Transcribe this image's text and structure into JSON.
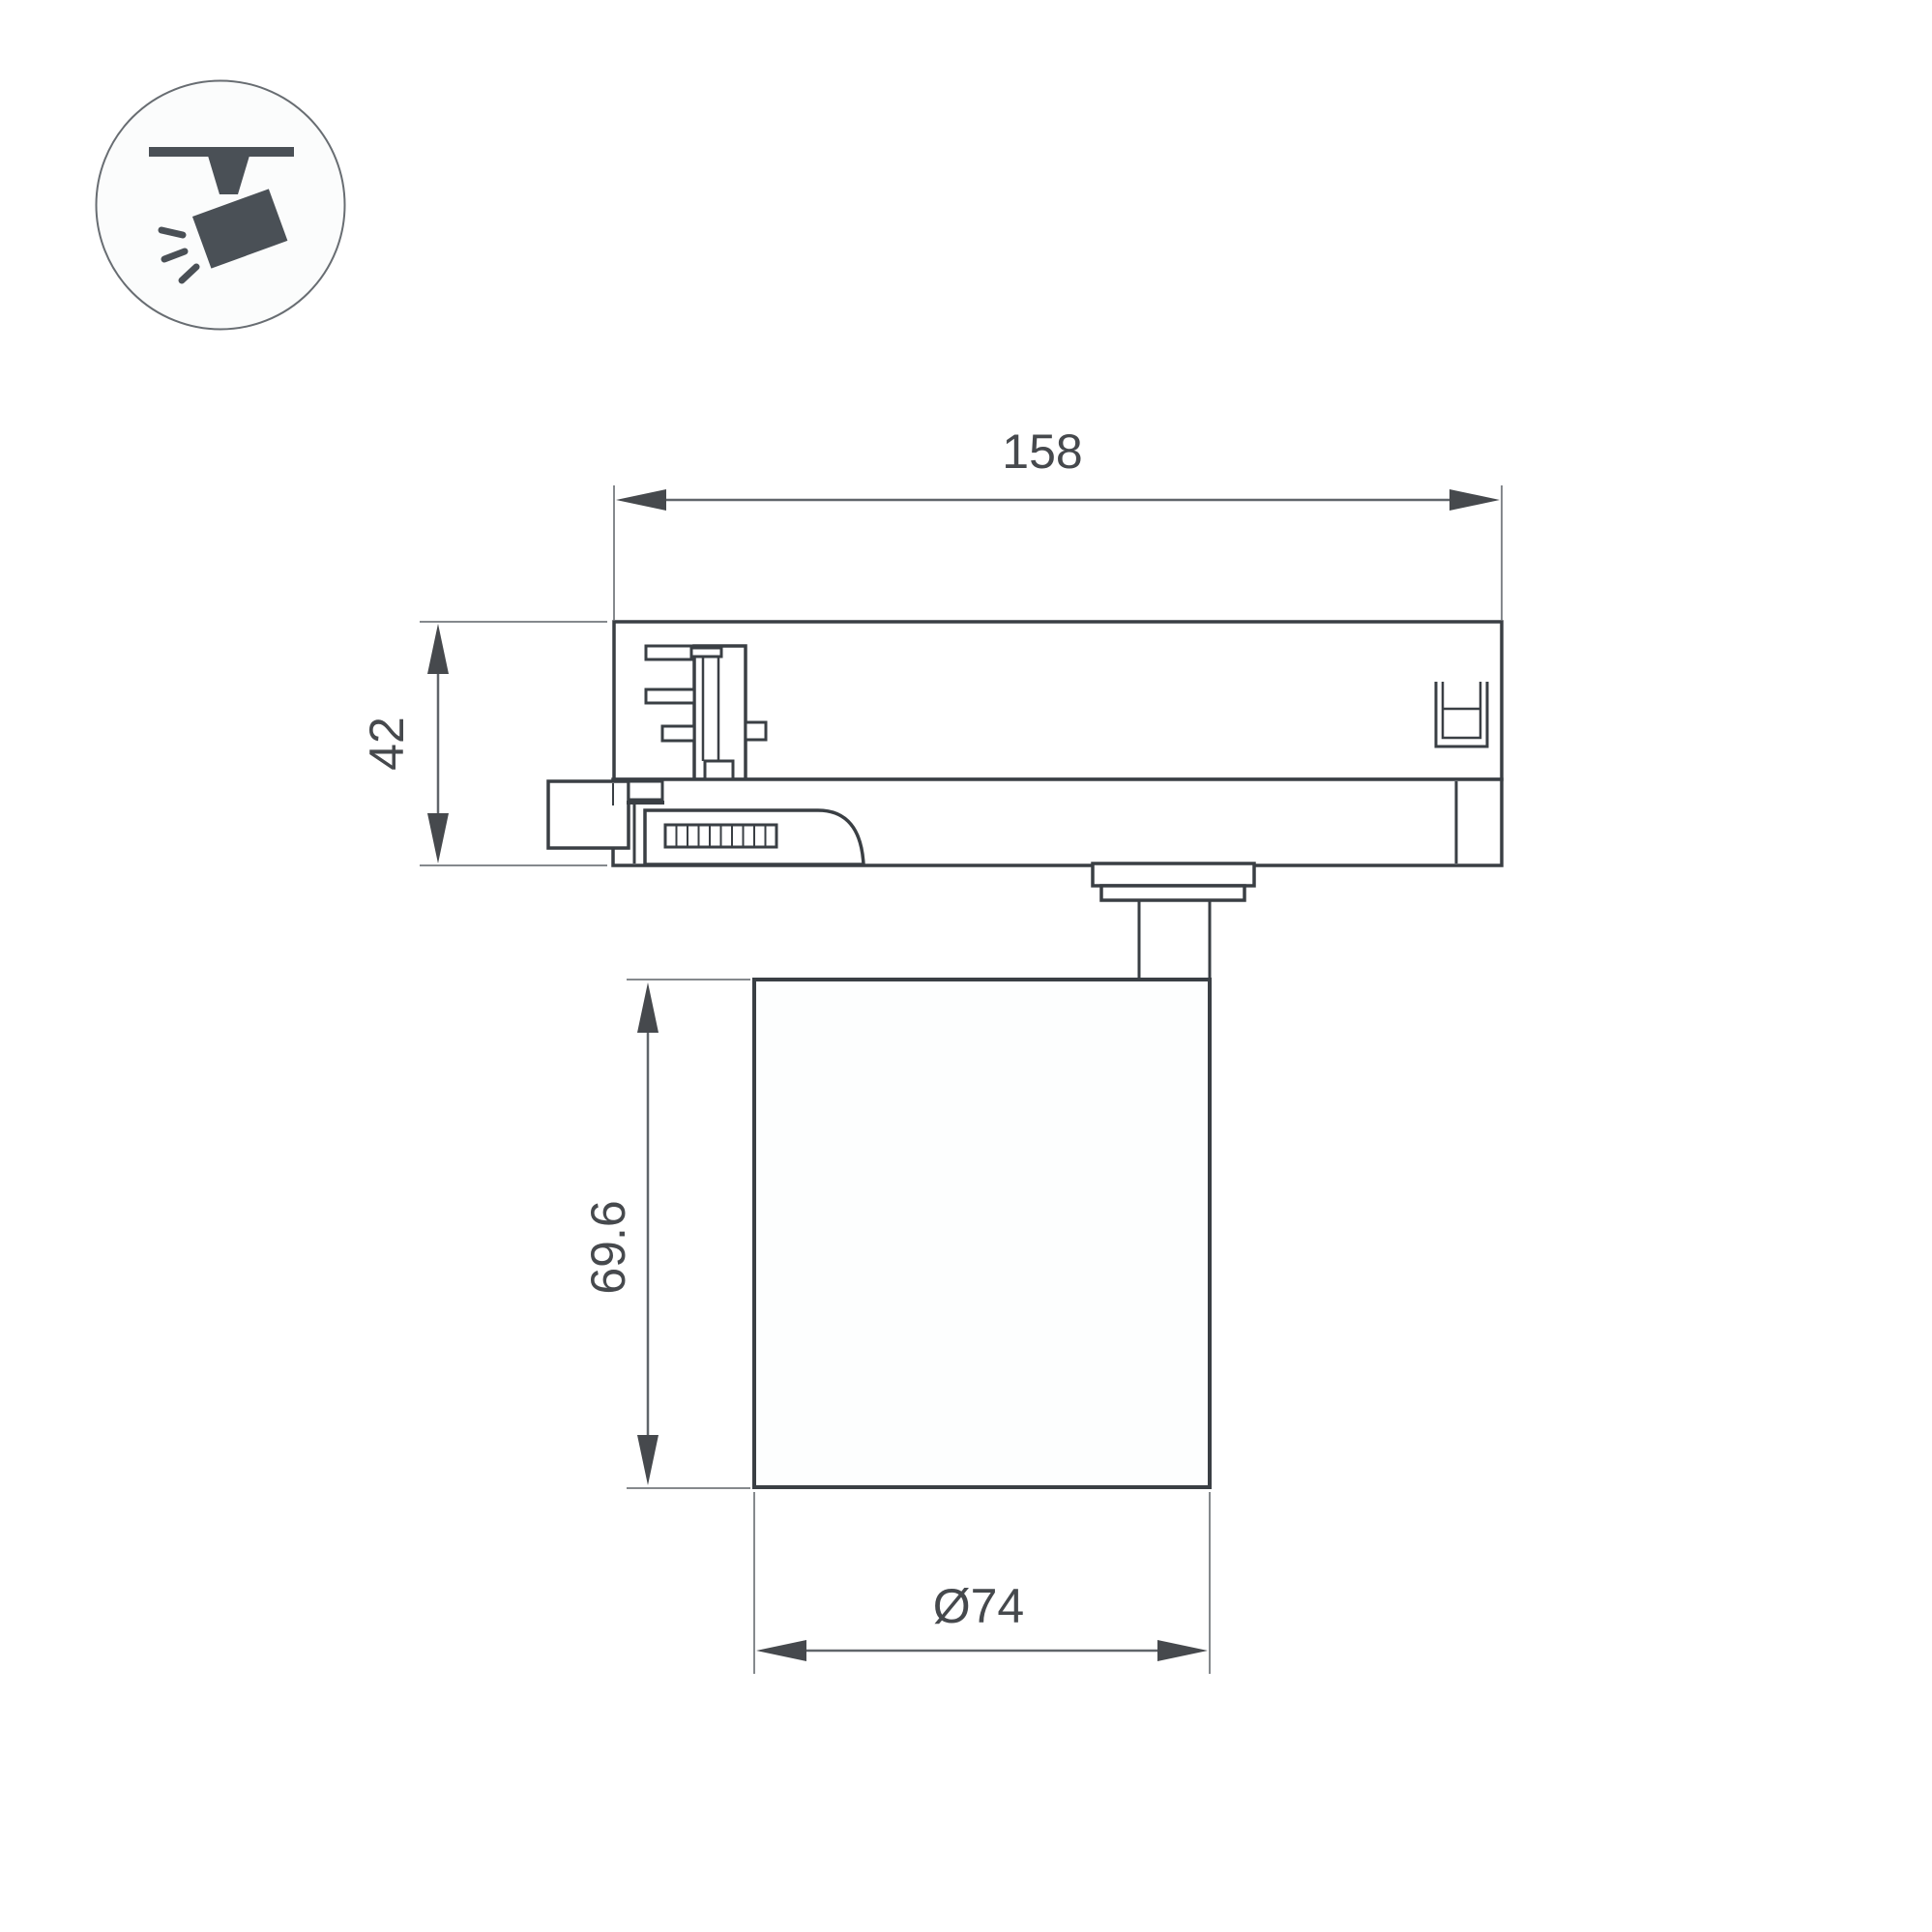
{
  "drawing": {
    "type": "technical-dimension-drawing",
    "subject": "track-light-fixture-side-view",
    "labels": {
      "adapter_width": "158",
      "adapter_height": "42",
      "body_height": "69.6",
      "body_diameter": "Ø74"
    },
    "icon": {
      "name": "track-spotlight-icon",
      "fill": "#4a5056",
      "circle_stroke": "#686d72"
    },
    "colors": {
      "background": "#ffffff",
      "outline": "#3a3f44",
      "dimension_line": "#60656a",
      "extension_line": "#85898d",
      "arrow": "#46494d",
      "text": "#46494d"
    }
  }
}
